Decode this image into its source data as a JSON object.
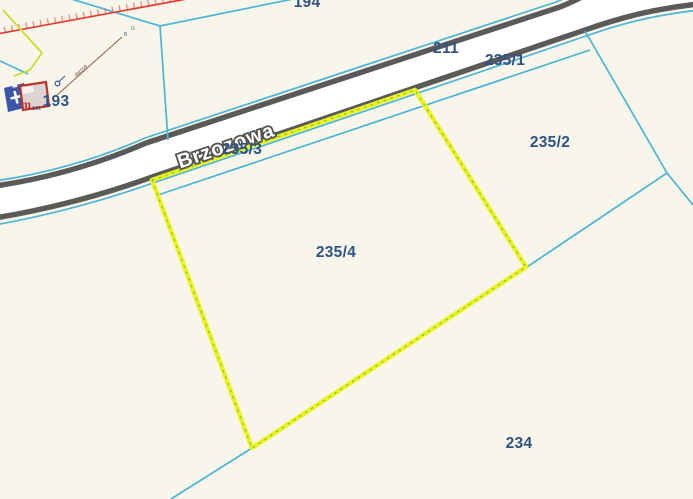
{
  "map": {
    "street": {
      "label": "Brzozowa"
    },
    "selected_parcel": "235/4",
    "parcels": {
      "p194": "194",
      "p211": "211",
      "p235_1": "235/1",
      "p235_2": "235/2",
      "p235_3": "235/3",
      "p235_4": "235/4",
      "p234": "234",
      "p193": "193"
    },
    "building": {
      "type_letter": "m",
      "small_label": "131"
    },
    "annotations": {
      "dimension_label": "4M159",
      "mark_1": "B",
      "mark_2": "G"
    },
    "colors": {
      "background": "#f8f5ea",
      "boundary_cyan": "#4ab5d6",
      "selected_yellow": "#edf21c",
      "selected_dash_green": "#5abf3f",
      "label_navy": "#2e5186",
      "road_casing": "#4d4d4b",
      "road_surface": "#ffffff",
      "red_line": "#e23a2e",
      "building_blue": "#3b55a8",
      "building_red": "#b5342c"
    }
  }
}
